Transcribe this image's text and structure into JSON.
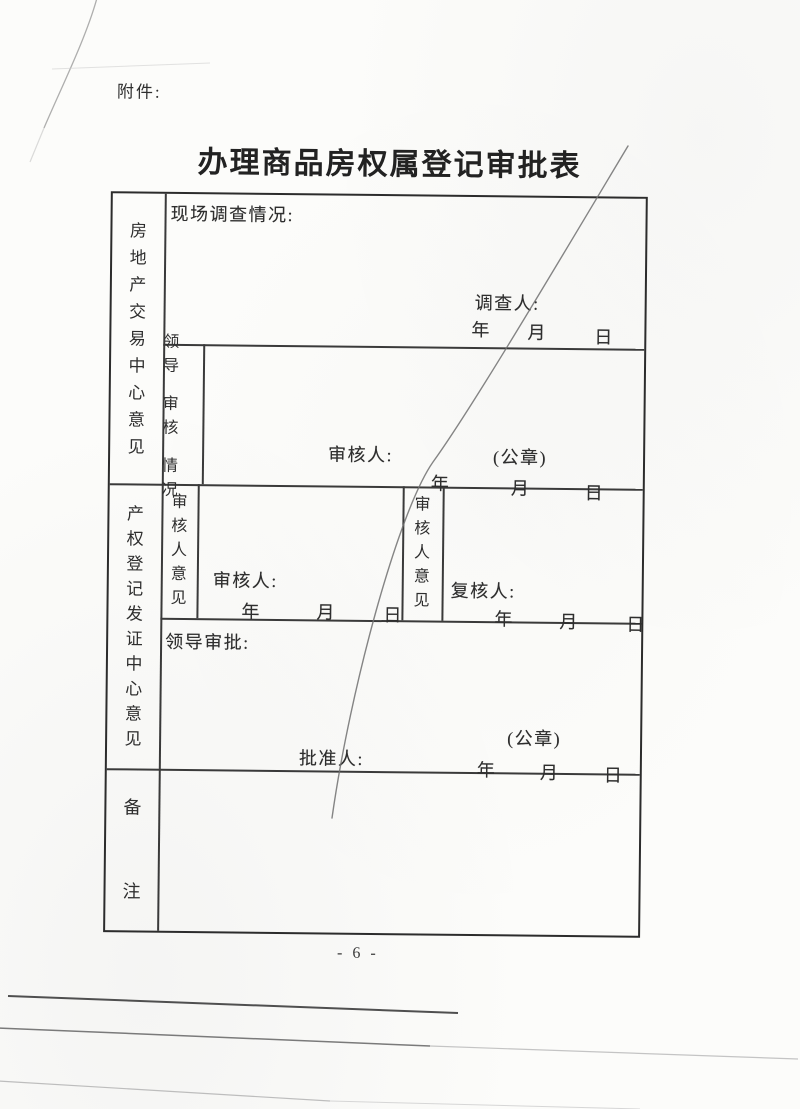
{
  "document": {
    "attachment_label": "附件:",
    "title": "办理商品房权属登记审批表",
    "page_number": "- 6 -"
  },
  "form": {
    "trading_center": {
      "side_label": "房地产交易中心意见",
      "site_investigation": {
        "label": "现场调查情况:",
        "investigator_label": "调查人:",
        "year": "年",
        "month": "月",
        "day": "日"
      },
      "leader_review": {
        "sub_label_lines": [
          "领 导",
          "审 核",
          "情 况"
        ],
        "reviewer_label": "审核人:",
        "seal_label": "(公章)",
        "year": "年",
        "month": "月",
        "day": "日"
      }
    },
    "registration_center": {
      "side_label": "产权登记发证中心意见",
      "review_opinion": {
        "sub_label": "审核人意见",
        "reviewer_label": "审核人:",
        "year": "年",
        "month": "月",
        "day": "日"
      },
      "recheck_opinion": {
        "sub_label": "审核人意见",
        "rechecker_label": "复核人:",
        "year": "年",
        "month": "月",
        "day": "日"
      },
      "leader_approval": {
        "label": "领导审批:",
        "seal_label": "(公章)",
        "approver_label": "批准人:",
        "year": "年",
        "month": "月",
        "day": "日"
      }
    },
    "remarks": {
      "label": "备注"
    }
  },
  "colors": {
    "paper": "#fcfcfa",
    "ink": "#2e2e2e",
    "crease": "#707070"
  }
}
